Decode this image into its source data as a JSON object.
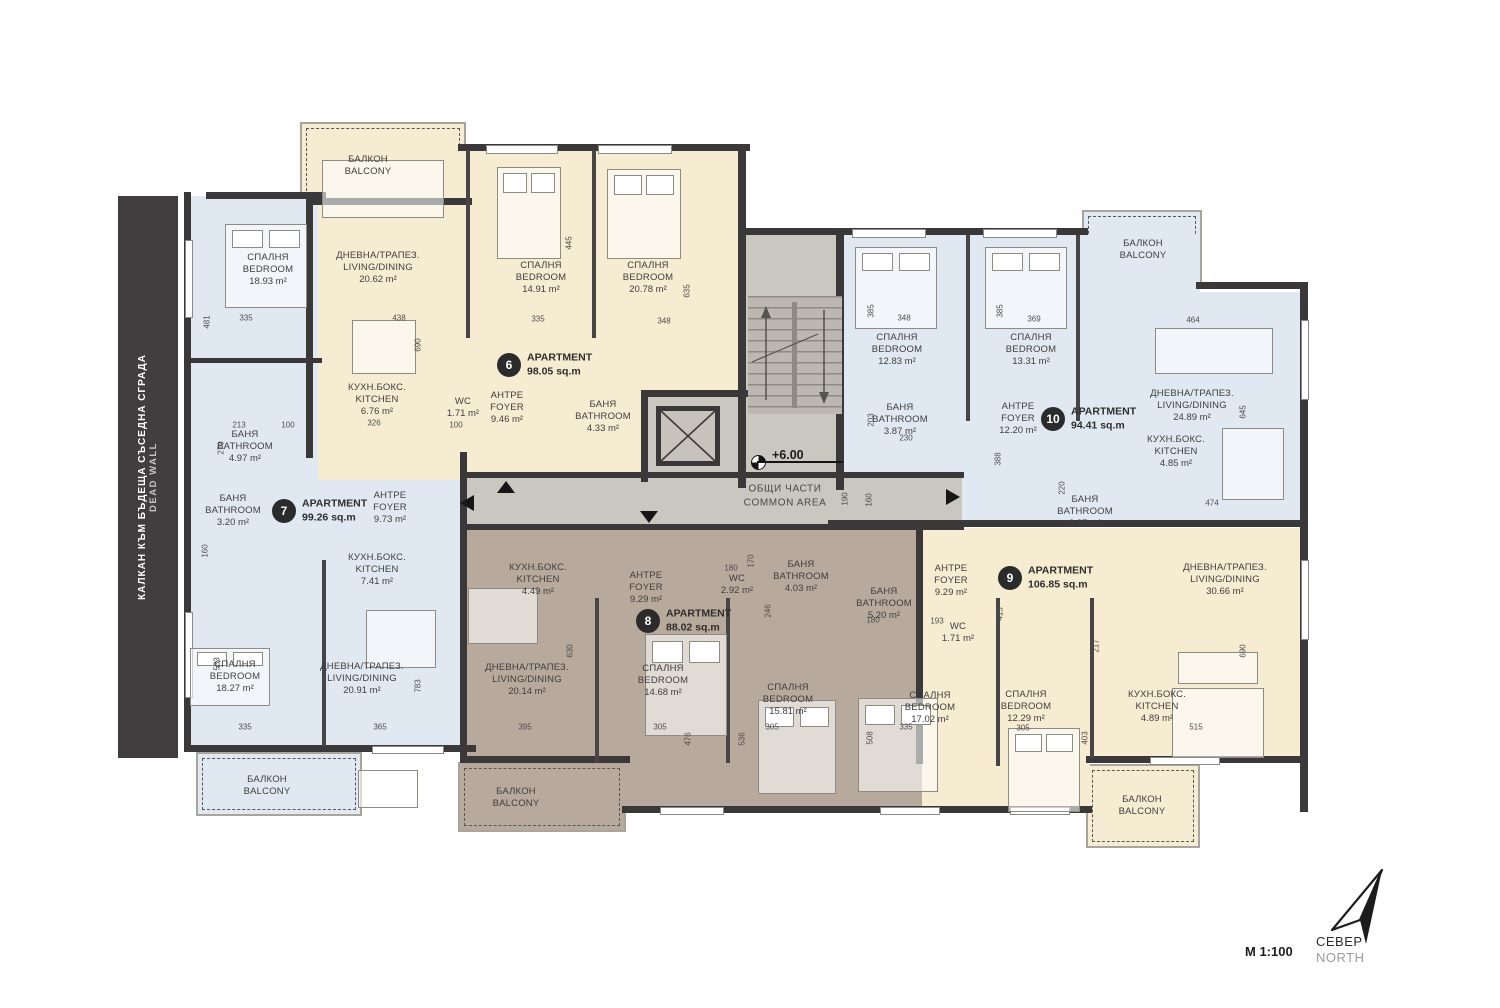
{
  "meta": {
    "scale_label": "М 1:100",
    "north_bg": "СЕВЕР",
    "north_en": "NORTH"
  },
  "dead_wall": {
    "line_bg": "КАЛКАН КЪМ БЪДЕЩА СЪСЕДНА СГРАДА",
    "line_en": "DEAD WALL"
  },
  "common_area": {
    "name_bg": "ОБЩИ ЧАСТИ",
    "name_en": "COMMON AREA",
    "level": "+6.00"
  },
  "colors": {
    "wall": "#3a3839",
    "cream": "#f6ecd2",
    "blue": "#e0e9f2",
    "taupe": "#b7a99c",
    "common": "#cac6c0"
  },
  "apartments": [
    {
      "number": "6",
      "title": "APARTMENT",
      "area": "98.05 sq.m",
      "rooms": [
        {
          "bg": "ДНЕВНА/ТРАПЕЗ.",
          "en": "LIVING/DINING",
          "area": "20.62 m²"
        },
        {
          "bg": "СПАЛНЯ",
          "en": "BEDROOM",
          "area": "14.91 m²"
        },
        {
          "bg": "СПАЛНЯ",
          "en": "BEDROOM",
          "area": "20.78 m²"
        },
        {
          "bg": "КУХН.БОКС.",
          "en": "KITCHEN",
          "area": "6.76 m²"
        },
        {
          "bg": "WC",
          "en": "",
          "area": "1.71 m²"
        },
        {
          "bg": "АНТРЕ",
          "en": "FOYER",
          "area": "9.46 m²"
        },
        {
          "bg": "БАНЯ",
          "en": "BATHROOM",
          "area": "4.33 m²"
        },
        {
          "bg": "БАЛКОН",
          "en": "BALCONY",
          "area": ""
        }
      ]
    },
    {
      "number": "7",
      "title": "APARTMENT",
      "area": "99.26 sq.m",
      "rooms": [
        {
          "bg": "СПАЛНЯ",
          "en": "BEDROOM",
          "area": "18.93 m²"
        },
        {
          "bg": "БАНЯ",
          "en": "BATHROOM",
          "area": "4.97 m²"
        },
        {
          "bg": "БАНЯ",
          "en": "BATHROOM",
          "area": "3.20 m²"
        },
        {
          "bg": "АНТРЕ",
          "en": "FOYER",
          "area": "9.73 m²"
        },
        {
          "bg": "КУХН.БОКС.",
          "en": "KITCHEN",
          "area": "7.41 m²"
        },
        {
          "bg": "СПАЛНЯ",
          "en": "BEDROOM",
          "area": "18.27 m²"
        },
        {
          "bg": "ДНЕВНА/ТРАПЕЗ.",
          "en": "LIVING/DINING",
          "area": "20.91 m²"
        },
        {
          "bg": "БАЛКОН",
          "en": "BALCONY",
          "area": ""
        }
      ]
    },
    {
      "number": "8",
      "title": "APARTMENT",
      "area": "88.02 sq.m",
      "rooms": [
        {
          "bg": "КУХН.БОКС.",
          "en": "KITCHEN",
          "area": "4.49 m²"
        },
        {
          "bg": "АНТРЕ",
          "en": "FOYER",
          "area": "9.29 m²"
        },
        {
          "bg": "WC",
          "en": "",
          "area": "2.92 m²"
        },
        {
          "bg": "БАНЯ",
          "en": "BATHROOM",
          "area": "4.03 m²"
        },
        {
          "bg": "ДНЕВНА/ТРАПЕЗ.",
          "en": "LIVING/DINING",
          "area": "20.14 m²"
        },
        {
          "bg": "СПАЛНЯ",
          "en": "BEDROOM",
          "area": "14.68 m²"
        },
        {
          "bg": "СПАЛНЯ",
          "en": "BEDROOM",
          "area": "15.81 m²"
        },
        {
          "bg": "БАЛКОН",
          "en": "BALCONY",
          "area": ""
        }
      ]
    },
    {
      "number": "9",
      "title": "APARTMENT",
      "area": "106.85 sq.m",
      "rooms": [
        {
          "bg": "АНТРЕ",
          "en": "FOYER",
          "area": "9.29 m²"
        },
        {
          "bg": "БАНЯ",
          "en": "BATHROOM",
          "area": "5.20 m²"
        },
        {
          "bg": "WC",
          "en": "",
          "area": "1.71 m²"
        },
        {
          "bg": "СПАЛНЯ",
          "en": "BEDROOM",
          "area": "17.02 m²"
        },
        {
          "bg": "СПАЛНЯ",
          "en": "BEDROOM",
          "area": "12.29 m²"
        },
        {
          "bg": "ДНЕВНА/ТРАПЕЗ.",
          "en": "LIVING/DINING",
          "area": "30.66 m²"
        },
        {
          "bg": "КУХН.БОКС.",
          "en": "KITCHEN",
          "area": "4.89 m²"
        },
        {
          "bg": "БАЛКОН",
          "en": "BALCONY",
          "area": ""
        }
      ]
    },
    {
      "number": "10",
      "title": "APARTMENT",
      "area": "94.41 sq.m",
      "rooms": [
        {
          "bg": "СПАЛНЯ",
          "en": "BEDROOM",
          "area": "12.83 m²"
        },
        {
          "bg": "СПАЛНЯ",
          "en": "BEDROOM",
          "area": "13.31 m²"
        },
        {
          "bg": "БАНЯ",
          "en": "BATHROOM",
          "area": "3.87 m²"
        },
        {
          "bg": "АНТРЕ",
          "en": "FOYER",
          "area": "12.20 m²"
        },
        {
          "bg": "ДНЕВНА/ТРАПЕЗ.",
          "en": "LIVING/DINING",
          "area": "24.89 m²"
        },
        {
          "bg": "КУХН.БОКС.",
          "en": "KITCHEN",
          "area": "4.85 m²"
        },
        {
          "bg": "БАНЯ",
          "en": "BATHROOM",
          "area": "3.87 m²"
        },
        {
          "bg": "БАЛКОН",
          "en": "BALCONY",
          "area": ""
        }
      ]
    }
  ],
  "dimensions": [
    [
      "481",
      207,
      322,
      1
    ],
    [
      "335",
      246,
      318,
      0
    ],
    [
      "438",
      399,
      318,
      0
    ],
    [
      "690",
      418,
      345,
      1
    ],
    [
      "213",
      239,
      425,
      0
    ],
    [
      "100",
      288,
      425,
      0
    ],
    [
      "326",
      374,
      423,
      0
    ],
    [
      "270",
      221,
      448,
      1
    ],
    [
      "100",
      456,
      425,
      0
    ],
    [
      "445",
      569,
      243,
      1
    ],
    [
      "335",
      538,
      319,
      0
    ],
    [
      "348",
      664,
      321,
      0
    ],
    [
      "635",
      687,
      291,
      1
    ],
    [
      "348",
      904,
      318,
      0
    ],
    [
      "369",
      1034,
      319,
      0
    ],
    [
      "385",
      871,
      311,
      1
    ],
    [
      "385",
      1000,
      311,
      1
    ],
    [
      "464",
      1193,
      320,
      0
    ],
    [
      "645",
      1243,
      412,
      1
    ],
    [
      "474",
      1212,
      503,
      0
    ],
    [
      "230",
      906,
      438,
      0
    ],
    [
      "160",
      869,
      500,
      1
    ],
    [
      "190",
      845,
      499,
      1
    ],
    [
      "388",
      998,
      459,
      1
    ],
    [
      "220",
      1062,
      488,
      1
    ],
    [
      "630",
      570,
      651,
      1
    ],
    [
      "395",
      525,
      727,
      0
    ],
    [
      "305",
      660,
      727,
      0
    ],
    [
      "476",
      688,
      739,
      1
    ],
    [
      "536",
      742,
      739,
      1
    ],
    [
      "305",
      772,
      727,
      0
    ],
    [
      "335",
      906,
      727,
      0
    ],
    [
      "508",
      870,
      738,
      1
    ],
    [
      "305",
      1023,
      728,
      0
    ],
    [
      "403",
      1085,
      738,
      1
    ],
    [
      "217",
      1096,
      646,
      1
    ],
    [
      "515",
      1196,
      727,
      0
    ],
    [
      "690",
      1243,
      651,
      1
    ],
    [
      "365",
      380,
      727,
      0
    ],
    [
      "335",
      245,
      727,
      0
    ],
    [
      "533",
      217,
      664,
      1
    ],
    [
      "783",
      418,
      686,
      1
    ],
    [
      "180",
      731,
      568,
      0
    ],
    [
      "170",
      751,
      561,
      1
    ],
    [
      "246",
      768,
      611,
      1
    ],
    [
      "415",
      1000,
      614,
      1
    ],
    [
      "193",
      937,
      621,
      0
    ],
    [
      "180",
      873,
      620,
      0
    ],
    [
      "160",
      205,
      551,
      1
    ],
    [
      "203",
      871,
      420,
      1
    ]
  ],
  "furniture": [
    [
      "bed",
      225,
      224,
      82,
      84
    ],
    [
      "bed",
      497,
      167,
      64,
      92
    ],
    [
      "bed",
      607,
      169,
      74,
      90
    ],
    [
      "bed",
      855,
      247,
      82,
      82
    ],
    [
      "bed",
      985,
      247,
      82,
      82
    ],
    [
      "bed",
      190,
      648,
      80,
      58
    ],
    [
      "bed",
      645,
      634,
      82,
      102
    ],
    [
      "bed",
      758,
      700,
      78,
      94
    ],
    [
      "bed",
      858,
      698,
      80,
      94
    ],
    [
      "bed",
      1008,
      728,
      72,
      84
    ],
    [
      "table",
      352,
      320,
      64,
      54
    ],
    [
      "table",
      366,
      610,
      70,
      58
    ],
    [
      "table",
      468,
      588,
      70,
      56
    ],
    [
      "table",
      1172,
      688,
      92,
      70
    ],
    [
      "table",
      1222,
      428,
      62,
      72
    ],
    [
      "sofa",
      322,
      160,
      122,
      58
    ],
    [
      "sofa",
      1155,
      328,
      118,
      46
    ],
    [
      "sofa",
      1178,
      652,
      80,
      32
    ],
    [
      "sofa",
      358,
      770,
      60,
      38
    ]
  ]
}
